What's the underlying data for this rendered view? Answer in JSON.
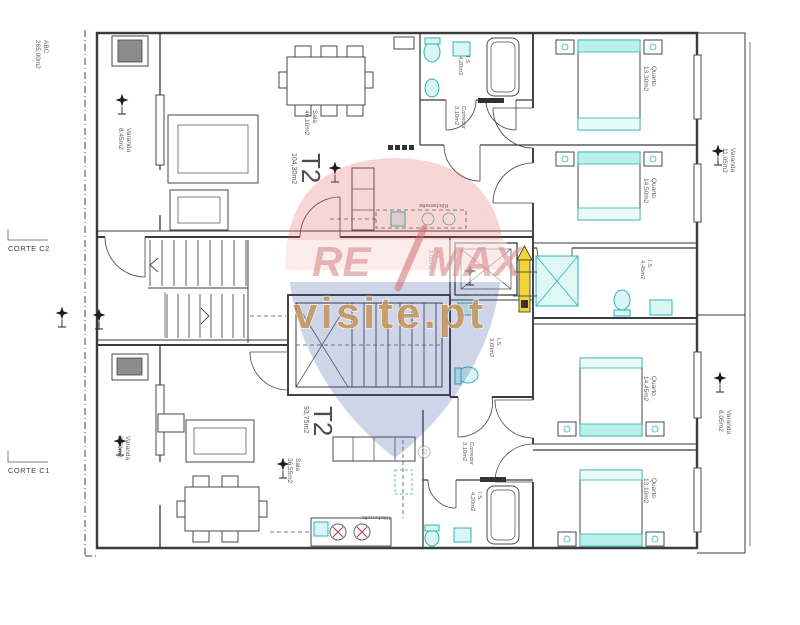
{
  "site": {
    "ref": "ABC",
    "ref_area": "265,00m2"
  },
  "sections": {
    "c2": "CORTE C2",
    "c1": "CORTE C1"
  },
  "top": {
    "type": "T2",
    "total": "104,30m2",
    "varandaL": {
      "label": "Varanda",
      "area": "8,45m2"
    },
    "sala": {
      "label": "Sala",
      "area": "46,10m2"
    },
    "is1": {
      "label": "I.S.",
      "area": "4,20m2"
    },
    "corredor": {
      "label": "Corredor",
      "area": "3,10m2"
    },
    "kitchenette": "Kitchenette",
    "quarto1": {
      "label": "Quarto",
      "area": "13,30m2"
    },
    "quarto2": {
      "label": "Quarto",
      "area": "14,50m2"
    },
    "is2": {
      "label": "I.S.",
      "area": "4,45m2"
    },
    "varandaR": {
      "label": "Varanda",
      "area": "11,05m2"
    }
  },
  "core": {
    "arr": {
      "label": "Arr.",
      "area": "2,05m2"
    },
    "is": {
      "label": "I.S.",
      "area": "3,60m2"
    }
  },
  "bottom": {
    "type": "T2",
    "total": "93,75m2",
    "varandaL": {
      "label": "Varanda",
      "area": "8,50m2"
    },
    "sala": {
      "label": "Sala",
      "area": "36,55m2"
    },
    "kitchenette": "Kitchenette",
    "corredor": {
      "label": "Corredor",
      "area": "3,10m2"
    },
    "is1": {
      "label": "I.S.",
      "area": "4,20m2"
    },
    "quarto1": {
      "label": "Quarto",
      "area": "14,45m2"
    },
    "quarto2": {
      "label": "Quarto",
      "area": "13,10m2"
    },
    "varandaR": {
      "label": "Varanda",
      "area": "8,05m2"
    }
  },
  "watermark": {
    "re": "RE",
    "slash": "/",
    "max": "MAX",
    "site": "visite.pt",
    "registered": "R"
  },
  "palette": {
    "fixture_cyan": "#2ab5b5",
    "wall": "#3b3b3b",
    "shaft_gray": "#8c8c8c",
    "marker_yellow": "#f2d437",
    "wm_red": "#e05252",
    "wm_blue": "#31519e",
    "wm_gold": "#c5975e"
  }
}
